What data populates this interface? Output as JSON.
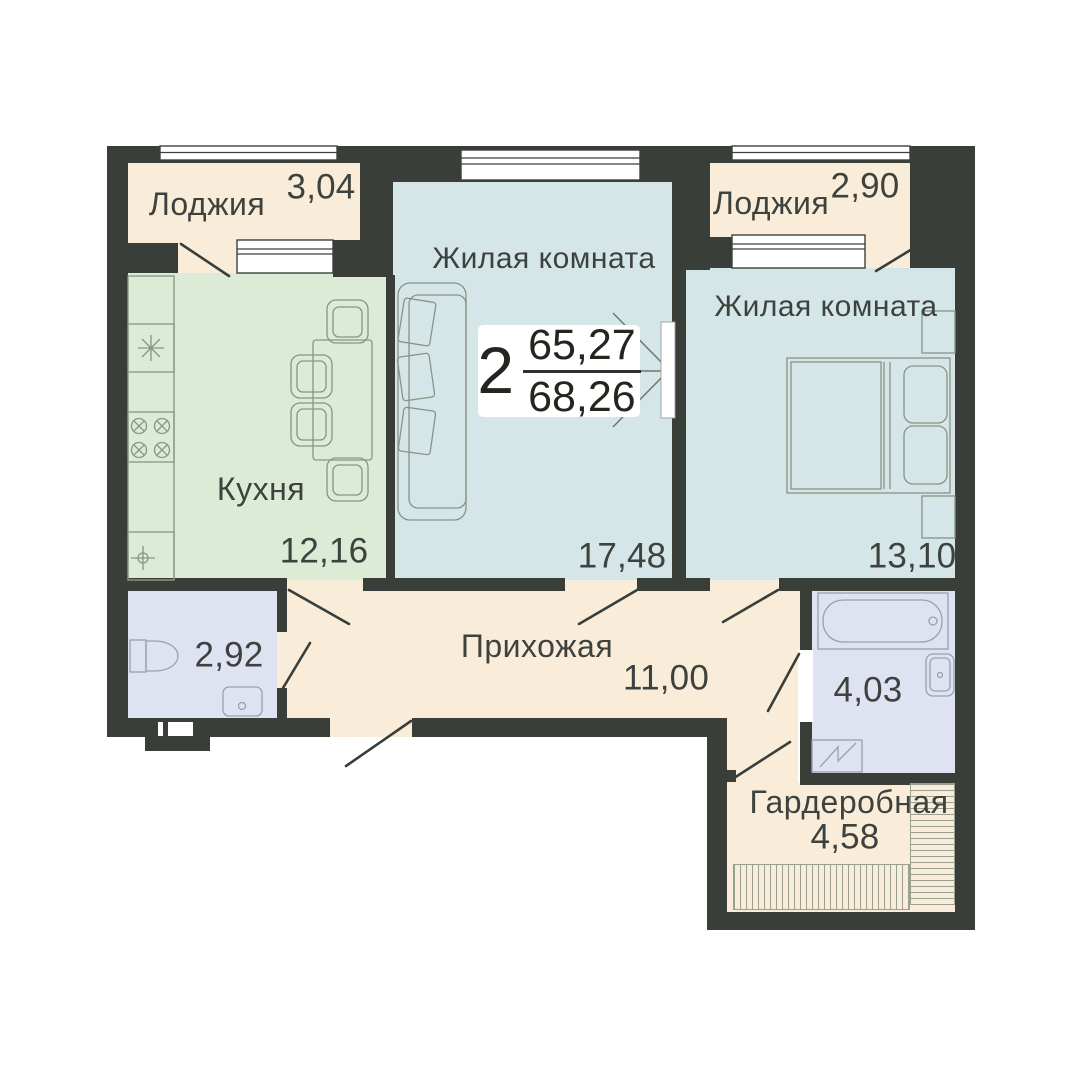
{
  "plan": {
    "type": "apartment-floor-plan",
    "badge": {
      "rooms_count": "2",
      "upper_area": "65,27",
      "lower_area": "68,26"
    },
    "rooms": [
      {
        "id": "loggia-left",
        "name": "Лоджия",
        "area": "3,04"
      },
      {
        "id": "kitchen",
        "name": "Кухня",
        "area": "12,16"
      },
      {
        "id": "living-room-center",
        "name": "Жилая комната",
        "area": "17,48"
      },
      {
        "id": "loggia-right",
        "name": "Лоджия",
        "area": "2,90"
      },
      {
        "id": "living-room-right",
        "name": "Жилая комната",
        "area": "13,10"
      },
      {
        "id": "wc",
        "name": "",
        "area": "2,92"
      },
      {
        "id": "hallway",
        "name": "Прихожая",
        "area": "11,00"
      },
      {
        "id": "bathroom",
        "name": "",
        "area": "4,03"
      },
      {
        "id": "wardrobe",
        "name": "Гардеробная",
        "area": "4,58"
      }
    ],
    "colors": {
      "wall": "#3a3e39",
      "loggia_hall": "#f9edda",
      "kitchen": "#dcebd5",
      "living": "#d5e6e8",
      "wet": "#dee2f1",
      "text": "#3e423e",
      "furniture": "#8a9384",
      "fixtures": "#9aa0b0",
      "hatch": "#9aa08f",
      "accent_line": "#2e322e"
    },
    "furniture_symbols": [
      "sofa",
      "dining-table",
      "chairs",
      "double-bed",
      "nightstands",
      "kitchen-sink",
      "stove",
      "bathtub",
      "washbasin",
      "toilet",
      "washing-machine",
      "wardrobe-rails",
      "door-swings",
      "windows",
      "direction-arrow"
    ]
  }
}
